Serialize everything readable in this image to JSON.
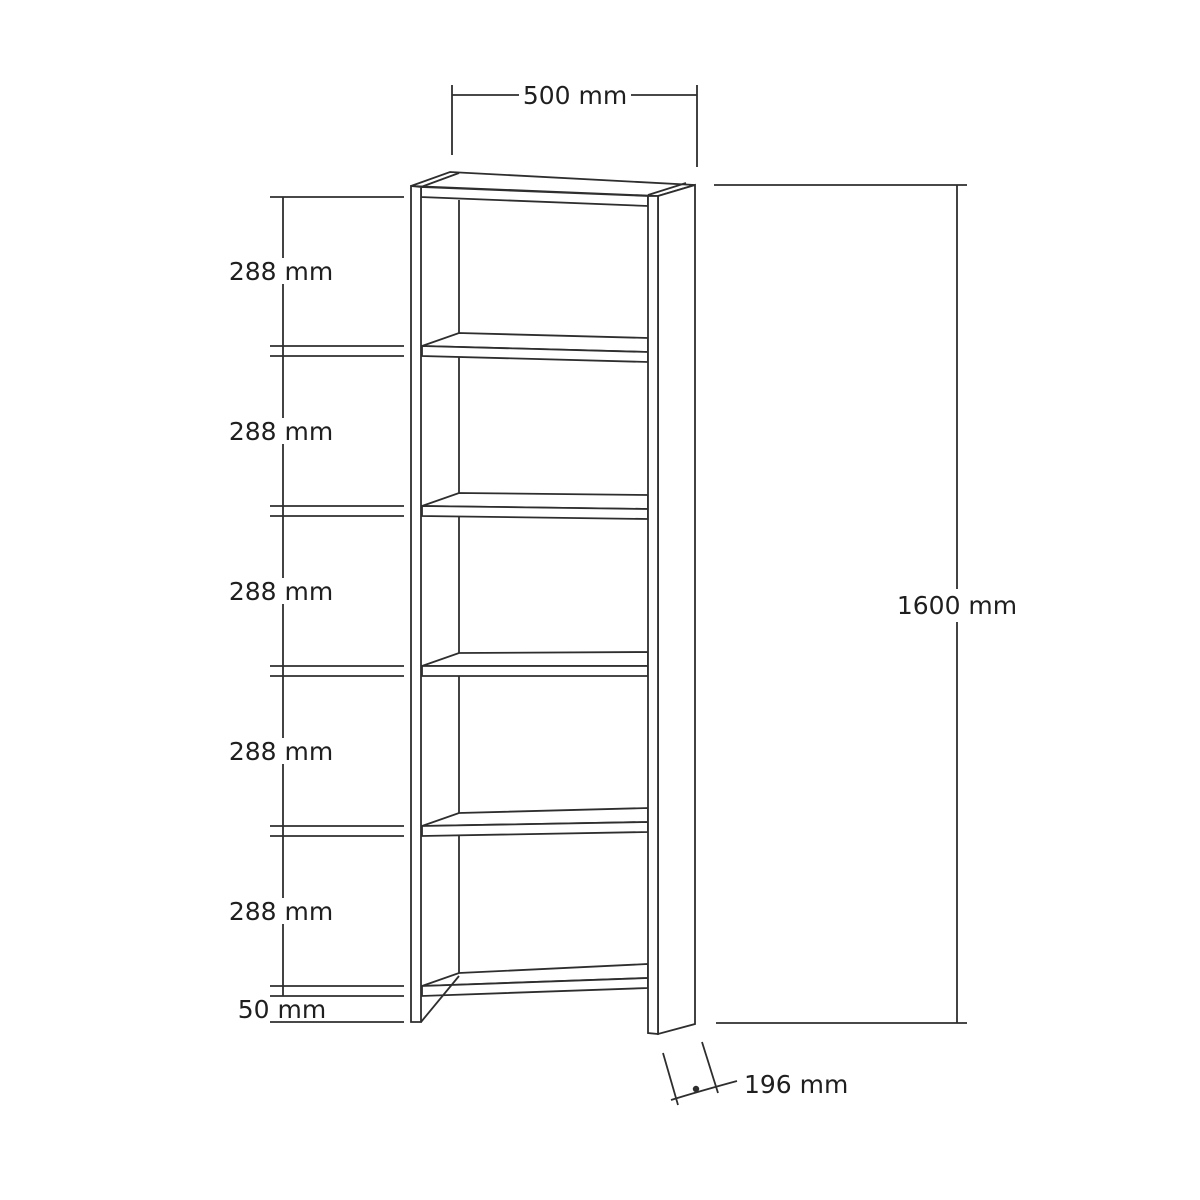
{
  "figure": {
    "title": "Bookshelf dimension drawing",
    "type": "technical-drawing",
    "subject": "5-shelf open bookcase shown in perspective with dimension lines"
  },
  "dimensions": {
    "width": {
      "label": "500 mm",
      "position": "top"
    },
    "height": {
      "label": "1600 mm",
      "position": "right"
    },
    "depth": {
      "label": "196 mm",
      "position": "bottom-right"
    },
    "bottom_clearance": {
      "label": "50 mm",
      "position": "bottom-left"
    },
    "shelf_spacings": [
      {
        "label": "288 mm"
      },
      {
        "label": "288 mm"
      },
      {
        "label": "288 mm"
      },
      {
        "label": "288 mm"
      },
      {
        "label": "288 mm"
      }
    ]
  },
  "colors": {
    "background": "#ffffff",
    "line": "#2e2e2e",
    "text": "#1f1f1f"
  }
}
